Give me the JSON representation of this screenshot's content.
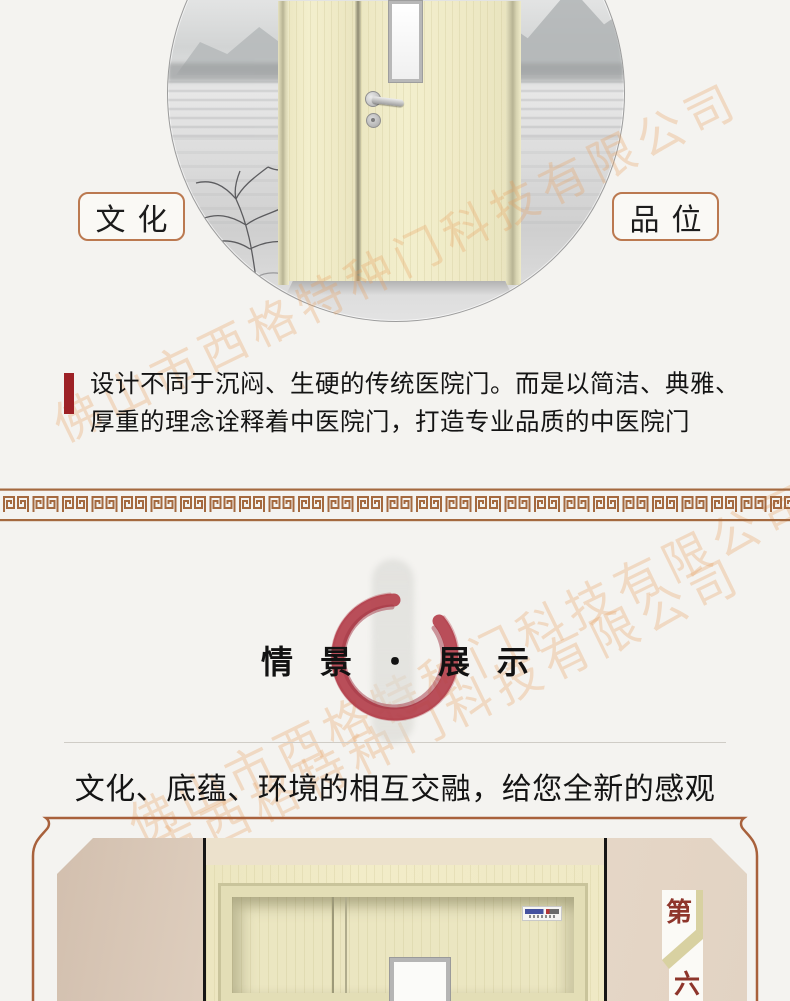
{
  "page": {
    "background": "#f4f3f0"
  },
  "watermark": {
    "text": "佛山市西格特种门科技有限公司",
    "color": "#e89e5c"
  },
  "hero": {
    "left_label": "文化",
    "right_label": "品位",
    "label_border_color": "#bb7950"
  },
  "intro": {
    "accent_color": "#9d2126",
    "line1": "设计不同于沉闷、生硬的传统医院门。而是以简洁、典雅、",
    "line2": "厚重的理念诠释着中医院门，打造专业品质的中医院门"
  },
  "meander": {
    "color": "#a4693f"
  },
  "section": {
    "title": "情景・展示",
    "subtitle": "文化、底蕴、环境的相互交融，给您全新的感观",
    "enso_color": "#b23c48"
  },
  "showcase": {
    "frame_color": "#a8613c",
    "badge_top": "第",
    "badge_bottom": "六",
    "badge_color": "#8e352b"
  }
}
